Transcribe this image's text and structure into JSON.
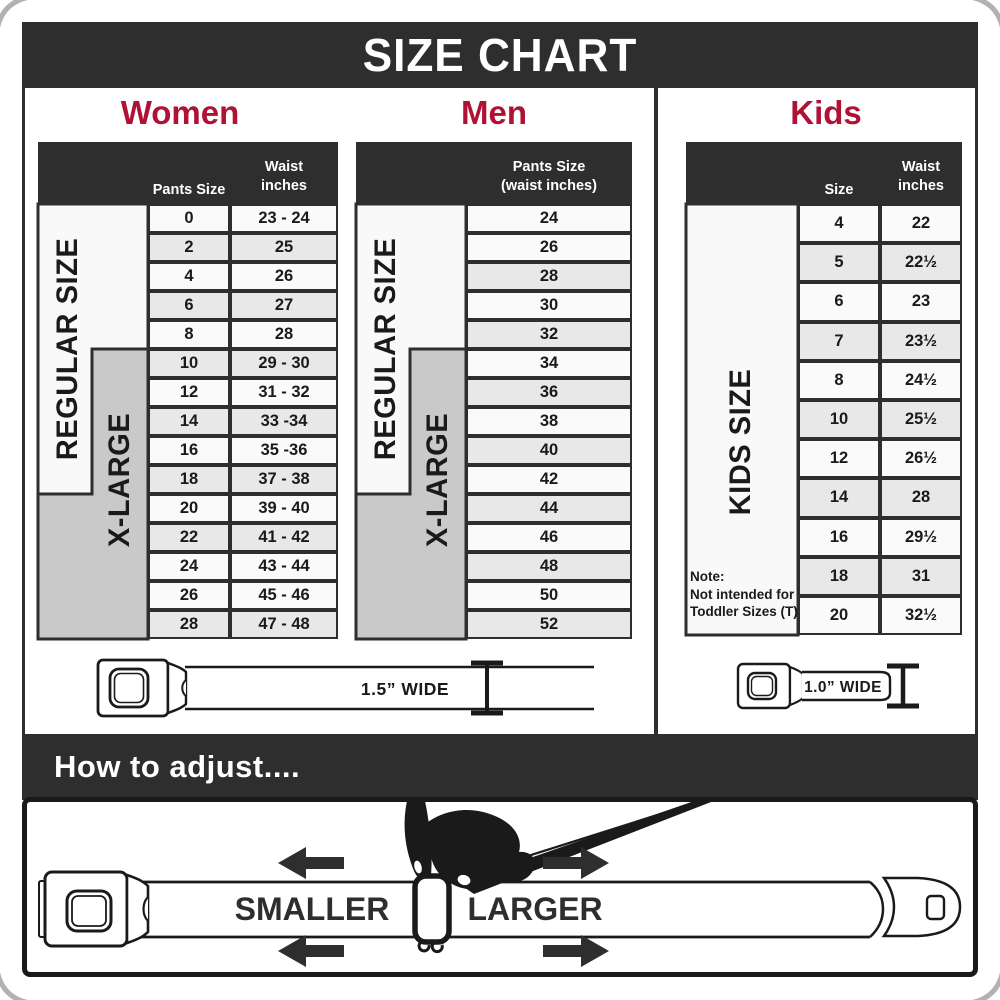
{
  "title": "SIZE CHART",
  "colors": {
    "dark": "#2e2e2e",
    "crimson": "#b01235",
    "xlarge_band_grey": "#c9c9c9",
    "row_shaded": "#e8e8e8",
    "row_plain": "#fafafa"
  },
  "sections": {
    "women": {
      "heading": "Women",
      "col_size_header": "Pants Size",
      "col_waist_header_line1": "Waist",
      "col_waist_header_line2": "inches",
      "regular_label": "REGULAR SIZE",
      "xlarge_label": "X-LARGE",
      "rows": [
        {
          "size": "0",
          "waist": "23 - 24",
          "shaded": false
        },
        {
          "size": "2",
          "waist": "25",
          "shaded": true
        },
        {
          "size": "4",
          "waist": "26",
          "shaded": false
        },
        {
          "size": "6",
          "waist": "27",
          "shaded": true
        },
        {
          "size": "8",
          "waist": "28",
          "shaded": false
        },
        {
          "size": "10",
          "waist": "29 - 30",
          "shaded": true
        },
        {
          "size": "12",
          "waist": "31 - 32",
          "shaded": false
        },
        {
          "size": "14",
          "waist": "33 -34",
          "shaded": true
        },
        {
          "size": "16",
          "waist": "35 -36",
          "shaded": false
        },
        {
          "size": "18",
          "waist": "37 - 38",
          "shaded": true
        },
        {
          "size": "20",
          "waist": "39 - 40",
          "shaded": false
        },
        {
          "size": "22",
          "waist": "41 - 42",
          "shaded": true
        },
        {
          "size": "24",
          "waist": "43 - 44",
          "shaded": false
        },
        {
          "size": "26",
          "waist": "45 - 46",
          "shaded": false
        },
        {
          "size": "28",
          "waist": "47 - 48",
          "shaded": true
        }
      ]
    },
    "men": {
      "heading": "Men",
      "col_header_line1": "Pants Size",
      "col_header_line2": "(waist inches)",
      "regular_label": "REGULAR SIZE",
      "xlarge_label": "X-LARGE",
      "rows": [
        {
          "size": "24",
          "shaded": false
        },
        {
          "size": "26",
          "shaded": false
        },
        {
          "size": "28",
          "shaded": true
        },
        {
          "size": "30",
          "shaded": false
        },
        {
          "size": "32",
          "shaded": true
        },
        {
          "size": "34",
          "shaded": false
        },
        {
          "size": "36",
          "shaded": true
        },
        {
          "size": "38",
          "shaded": false
        },
        {
          "size": "40",
          "shaded": true
        },
        {
          "size": "42",
          "shaded": false
        },
        {
          "size": "44",
          "shaded": true
        },
        {
          "size": "46",
          "shaded": false
        },
        {
          "size": "48",
          "shaded": true
        },
        {
          "size": "50",
          "shaded": false
        },
        {
          "size": "52",
          "shaded": true
        }
      ]
    },
    "kids": {
      "heading": "Kids",
      "col_size_header": "Size",
      "col_waist_header_line1": "Waist",
      "col_waist_header_line2": "inches",
      "kids_label": "KIDS SIZE",
      "note_lines": [
        "Note:",
        "Not intended for",
        "Toddler Sizes (T)"
      ],
      "rows": [
        {
          "size": "4",
          "waist": "22",
          "shaded": false
        },
        {
          "size": "5",
          "waist": "22½",
          "shaded": true
        },
        {
          "size": "6",
          "waist": "23",
          "shaded": false
        },
        {
          "size": "7",
          "waist": "23½",
          "shaded": true
        },
        {
          "size": "8",
          "waist": "24½",
          "shaded": false
        },
        {
          "size": "10",
          "waist": "25½",
          "shaded": true
        },
        {
          "size": "12",
          "waist": "26½",
          "shaded": false
        },
        {
          "size": "14",
          "waist": "28",
          "shaded": true
        },
        {
          "size": "16",
          "waist": "29½",
          "shaded": false
        },
        {
          "size": "18",
          "waist": "31",
          "shaded": true
        },
        {
          "size": "20",
          "waist": "32½",
          "shaded": false
        }
      ]
    }
  },
  "belts": {
    "women_men": {
      "label": "1.5” WIDE"
    },
    "kids": {
      "label": "1.0” WIDE"
    }
  },
  "adjust": {
    "heading": "How to adjust....",
    "smaller": "SMALLER",
    "larger": "LARGER"
  }
}
